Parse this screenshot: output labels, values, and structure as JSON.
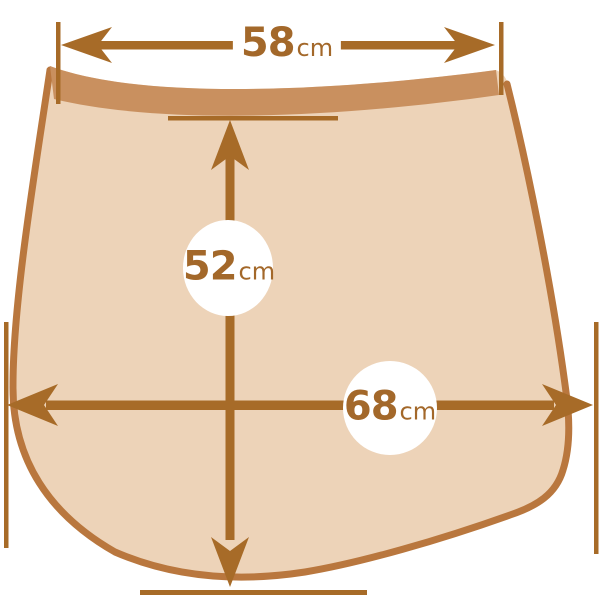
{
  "measurements": {
    "top_width": {
      "value": "58",
      "unit": "cm"
    },
    "center_height": {
      "value": "52",
      "unit": "cm"
    },
    "bottom_width": {
      "value": "68",
      "unit": "cm"
    }
  },
  "colors": {
    "background": "#FFFFFF",
    "fabric_fill": "#EDD3B8",
    "waistband": "#C9905F",
    "outline": "#B9773E",
    "arrow": "#A76B28",
    "label_text": "#A3682A",
    "bubble": "#FFFFFF"
  }
}
